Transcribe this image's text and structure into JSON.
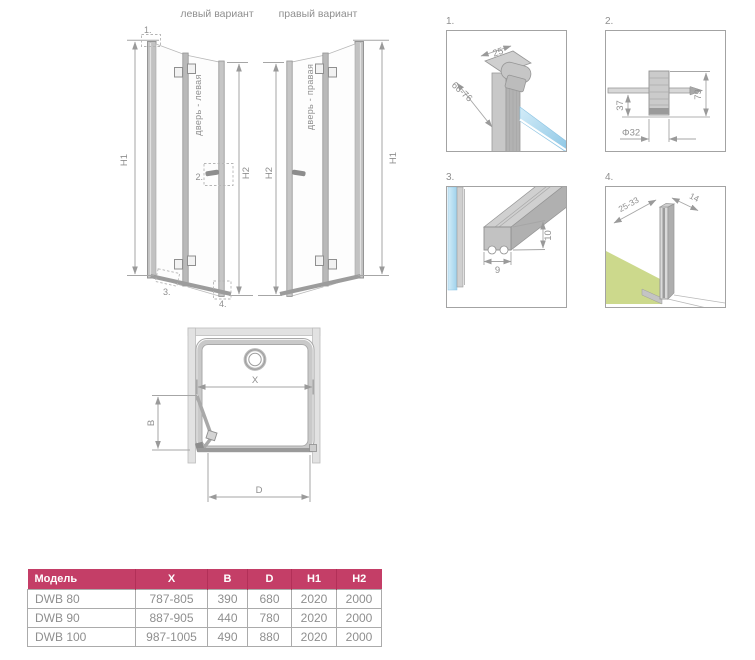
{
  "variants": {
    "left": "левый вариант",
    "right": "правый вариант",
    "door_left": "дверь - левая",
    "door_right": "дверь - правая"
  },
  "dims": {
    "h1": "H1",
    "h2": "H2",
    "x": "X",
    "b": "B",
    "d": "D"
  },
  "callouts": {
    "c1": "1.",
    "c2": "2.",
    "c3": "3.",
    "c4": "4."
  },
  "details": {
    "d1": {
      "label": "1.",
      "dim_width": "25",
      "dim_range": "66-76"
    },
    "d2": {
      "label": "2.",
      "dim_offset": "37",
      "dim_height": "79",
      "dim_diameter": "Φ32"
    },
    "d3": {
      "label": "3.",
      "dim_width": "9",
      "dim_height": "10"
    },
    "d4": {
      "label": "4.",
      "dim_range": "25-33",
      "dim_depth": "14"
    }
  },
  "table": {
    "headers": [
      "Модель",
      "X",
      "B",
      "D",
      "H1",
      "H2"
    ],
    "rows": [
      [
        "DWB 80",
        "787-805",
        "390",
        "680",
        "2020",
        "2000"
      ],
      [
        "DWB 90",
        "887-905",
        "440",
        "780",
        "2020",
        "2000"
      ],
      [
        "DWB 100",
        "987-1005",
        "490",
        "880",
        "2020",
        "2000"
      ]
    ]
  },
  "colors": {
    "table_header": "#c43e67",
    "glass_blue": "#8fc8e6",
    "floor_green": "#ccd98c",
    "line_gray": "#9a9a9a"
  }
}
